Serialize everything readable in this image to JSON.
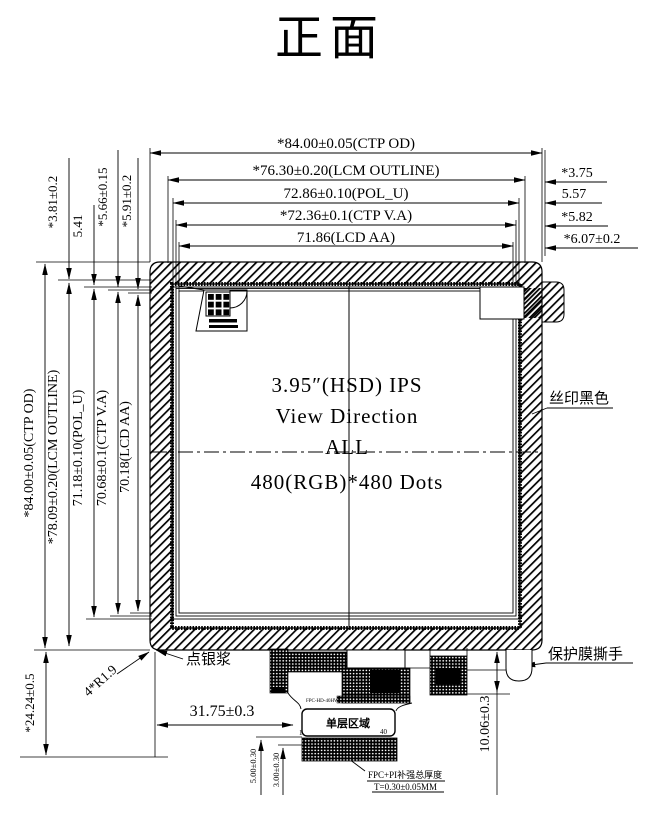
{
  "title": "正面",
  "display": {
    "size_line": "3.95″(HSD) IPS",
    "view_line": "View Direction",
    "view_value": "ALL",
    "resolution": "480(RGB)*480 Dots"
  },
  "dims_top": [
    "*84.00±0.05(CTP OD)",
    "*76.30±0.20(LCM OUTLINE)",
    "72.86±0.10(POL_U)",
    "*72.36±0.1(CTP V.A)",
    "71.86(LCD AA)"
  ],
  "dims_top_left": [
    "*3.81±0.2",
    "5.41",
    "*5.66±0.15",
    "*5.91±0.2"
  ],
  "dims_right": [
    "*3.75",
    "5.57",
    "*5.82",
    "*6.07±0.2"
  ],
  "dims_left": [
    "*84.00±0.05(CTP OD)",
    "*78.09±0.20(LCM OUTLINE)",
    "71.18±0.10(POL_U)",
    "70.68±0.1(CTP V.A)",
    "70.18(LCD AA)"
  ],
  "dims_bottom": {
    "left_height": "*24.24±0.5",
    "corner_radius": "4*R1.9",
    "fpc_offset": "31.75±0.3",
    "thickness_a": "5.00±0.30",
    "thickness_b": "3.00±0.30",
    "fpc_height": "10.06±0.3"
  },
  "labels": {
    "silver_paste": "点银浆",
    "silk_black": "丝印黑色",
    "film_tab": "保护膜撕手",
    "single_layer": "单层区域",
    "pin_first": "1",
    "pin_last": "40",
    "fpc_part": "FPC-HD-40HW",
    "note_line1": "FPC+PI补强总厚度",
    "note_line2": "T=0.30±0.05MM"
  }
}
